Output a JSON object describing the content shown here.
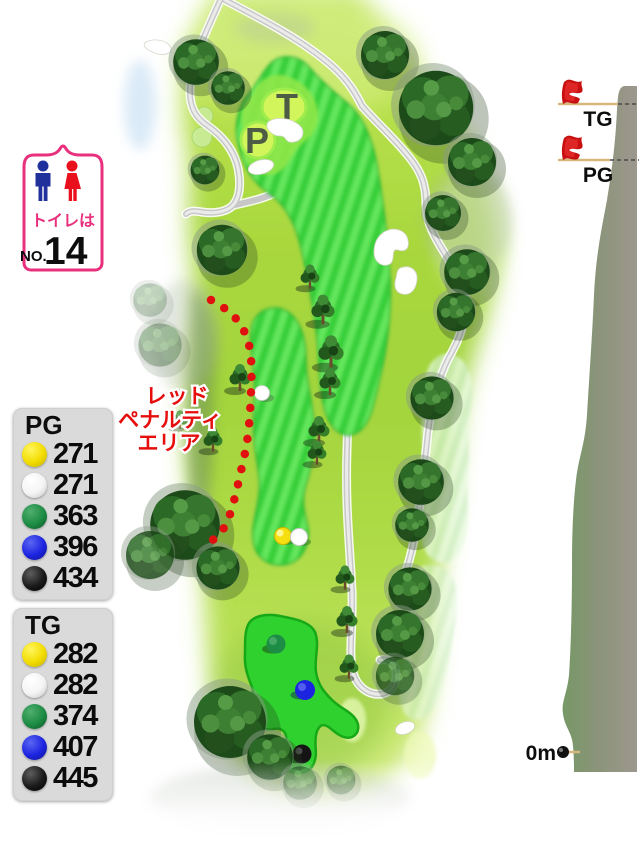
{
  "toilet_sign": {
    "line1": "トイレは",
    "no_prefix": "NO.",
    "number": "14"
  },
  "distance_panels": {
    "pg": {
      "header": "PG",
      "rows": [
        {
          "tee": "yellow",
          "distance": "271"
        },
        {
          "tee": "white",
          "distance": "271"
        },
        {
          "tee": "green",
          "distance": "363"
        },
        {
          "tee": "blue",
          "distance": "396"
        },
        {
          "tee": "black",
          "distance": "434"
        }
      ]
    },
    "tg": {
      "header": "TG",
      "rows": [
        {
          "tee": "yellow",
          "distance": "282"
        },
        {
          "tee": "white",
          "distance": "282"
        },
        {
          "tee": "green",
          "distance": "374"
        },
        {
          "tee": "blue",
          "distance": "407"
        },
        {
          "tee": "black",
          "distance": "445"
        }
      ]
    }
  },
  "penalty_area": {
    "lines": [
      "レッド",
      "ペナルティ",
      "エリア"
    ]
  },
  "greens": {
    "t": "T",
    "p": "P"
  },
  "elevation_profile": {
    "flag_labels": [
      "TG",
      "PG"
    ],
    "origin_label": "0m"
  },
  "colors": {
    "accent_pink": "#e8307c",
    "penalty_red": "#e60d0d",
    "fairway_green": "#3ed23e",
    "tee_yellow": "#f2dc00",
    "tee_white": "#ffffff",
    "tee_green": "#1d8c44",
    "tee_blue": "#1c24e0",
    "tee_black": "#161616"
  }
}
